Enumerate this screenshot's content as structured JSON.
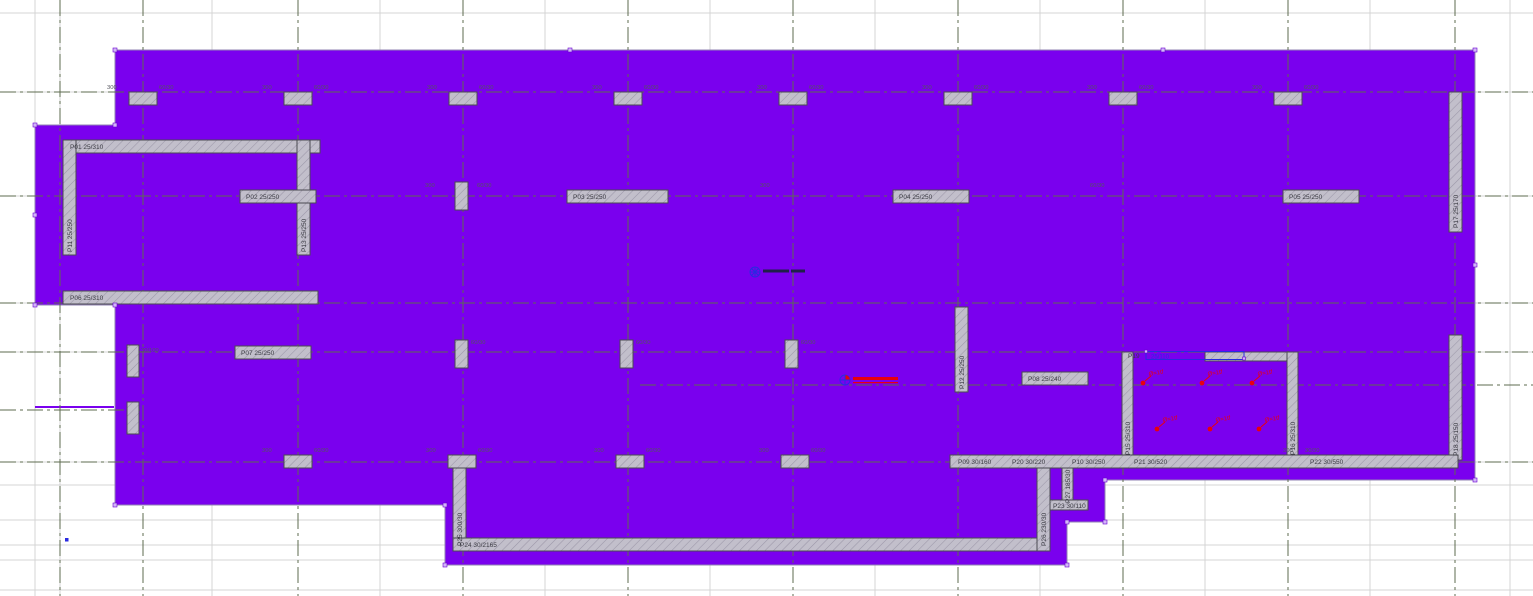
{
  "drawing": {
    "slab_color": "#7a00ee",
    "wall_color": "#c2bfcb",
    "selection_color": "#2a2ae0",
    "load_color": "#e8000d",
    "axis_color": "#5d6b4f"
  },
  "wall_labels": {
    "p01": "P01 25/310",
    "p02": "P02 25/250",
    "p03": "P03 25/250",
    "p04": "P04 25/250",
    "p05": "P05 25/250",
    "p06": "P06 25/310",
    "p07": "P07 25/250",
    "p08": "P08 25/240",
    "p09": "P09 30/160",
    "p10": "P10 30/250",
    "p11": "P11 25/250",
    "p12": "P12 25/250",
    "p13": "P13 25/250",
    "p15": "P15 25/310",
    "p16": "P16 25/310",
    "p17": "P17 25/170",
    "p18": "P18 25/150",
    "p19": "P19",
    "p19_section": "25/110",
    "p20": "P20 30/220",
    "p21": "P21 30/520",
    "p22": "P22 30/550",
    "p23": "P23 30/110",
    "p24": "P24 30/2165",
    "p25": "P25 300/30",
    "p26": "P26 230/30",
    "p27": "P27 185/30"
  },
  "axis_marks": {
    "column": "60/30",
    "span": "300",
    "column_wide": "30/100",
    "corner": "30/30"
  },
  "loads": {
    "point_load": "Ø=1tf"
  }
}
